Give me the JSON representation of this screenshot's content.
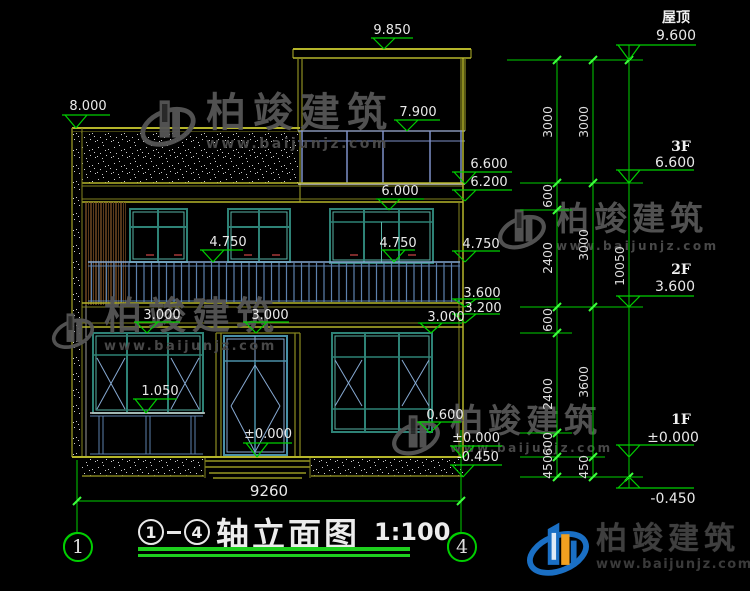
{
  "title_block": {
    "axis_from": "1",
    "axis_to": "4",
    "title": "轴立面图",
    "scale": "1:100"
  },
  "axis_bubbles": {
    "left": "1",
    "right": "4"
  },
  "bottom_dim": {
    "total_width": "9260"
  },
  "watermark": {
    "brand": "柏竣建筑",
    "url": "www.baijunjz.com"
  },
  "brand_footer": {
    "brand": "柏竣建筑",
    "url": "www.baijunjz.com"
  },
  "colors": {
    "dim_green": "#00cf00",
    "wall_olive": "#8f8f2d",
    "frame_teal": "#2e8276",
    "rail_blue": "#5d81ad",
    "logo_blue": "#1a6fc4",
    "logo_orange": "#f0a020"
  },
  "drawing": {
    "marks": [
      {
        "t": "9.850",
        "x": 392,
        "y": 24,
        "u": [
          371,
          413,
          38
        ],
        "tip": [
          384,
          49
        ]
      },
      {
        "t": "8.000",
        "x": 88,
        "y": 100,
        "u": [
          62,
          110,
          115
        ],
        "tip": [
          76,
          128
        ]
      },
      {
        "t": "7.900",
        "x": 418,
        "y": 106,
        "u": [
          394,
          440,
          120
        ],
        "tip": [
          407,
          131
        ]
      },
      {
        "t": "6.600",
        "x": 489,
        "y": 158,
        "u": [
          452,
          512,
          172
        ],
        "tip": [
          465,
          184
        ]
      },
      {
        "t": "6.200",
        "x": 489,
        "y": 176,
        "u": [
          452,
          512,
          190
        ],
        "tip": [
          465,
          201
        ]
      },
      {
        "t": "6.000",
        "x": 400,
        "y": 185,
        "u": [
          376,
          424,
          199
        ],
        "tip": [
          389,
          210
        ]
      },
      {
        "t": "4.750",
        "x": 228,
        "y": 236,
        "u": [
          200,
          243,
          250
        ],
        "tip": [
          213,
          262
        ]
      },
      {
        "t": "4.750",
        "x": 398,
        "y": 237,
        "u": [
          381,
          415,
          250
        ],
        "tip": [
          394,
          262
        ]
      },
      {
        "t": "4.750",
        "x": 481,
        "y": 238,
        "u": [
          452,
          500,
          251
        ],
        "tip": [
          465,
          262
        ]
      },
      {
        "t": "3.600",
        "x": 482,
        "y": 287,
        "u": [
          452,
          500,
          299
        ],
        "tip": [
          465,
          307
        ]
      },
      {
        "t": "3.200",
        "x": 483,
        "y": 302,
        "u": [
          452,
          500,
          314
        ],
        "tip": [
          465,
          323
        ]
      },
      {
        "t": "3.000",
        "x": 162,
        "y": 309,
        "u": [
          134,
          180,
          322
        ],
        "tip": [
          147,
          333
        ]
      },
      {
        "t": "3.000",
        "x": 270,
        "y": 309,
        "u": [
          243,
          289,
          322
        ],
        "tip": [
          256,
          333
        ]
      },
      {
        "t": "3.000",
        "x": 446,
        "y": 311,
        "u": [
          418,
          462,
          323
        ],
        "tip": [
          431,
          333
        ]
      },
      {
        "t": "1.050",
        "x": 160,
        "y": 385,
        "u": [
          133,
          177,
          399
        ],
        "tip": [
          146,
          413
        ]
      },
      {
        "t": "±0.000",
        "x": 268,
        "y": 428,
        "u": [
          243,
          292,
          443
        ],
        "tip": [
          257,
          457
        ]
      },
      {
        "t": "0.600",
        "x": 445,
        "y": 409,
        "u": [
          417,
          461,
          422
        ],
        "tip": [
          430,
          433
        ]
      },
      {
        "t": "±0.000",
        "x": 476,
        "y": 432,
        "u": [
          450,
          502,
          446
        ],
        "tip": [
          463,
          458
        ]
      },
      {
        "t": "-0.450",
        "x": 478,
        "y": 451,
        "u": [
          450,
          502,
          465
        ],
        "tip": [
          463,
          477
        ]
      }
    ],
    "floor_marks": [
      {
        "name": "屋顶",
        "value": "9.600",
        "nx": 676,
        "ny": 11,
        "vx": 676,
        "vy": 29,
        "u": [
          616,
          696,
          45
        ],
        "tip": [
          629,
          60
        ]
      },
      {
        "name": "3F",
        "value": "6.600",
        "nx": 681,
        "ny": 140,
        "vx": 675,
        "vy": 156,
        "u": [
          616,
          694,
          170
        ],
        "tip": [
          629,
          183
        ]
      },
      {
        "name": "2F",
        "value": "3.600",
        "nx": 681,
        "ny": 263,
        "vx": 675,
        "vy": 280,
        "u": [
          616,
          694,
          296
        ],
        "tip": [
          629,
          307
        ]
      },
      {
        "name": "1F",
        "value": "±0.000",
        "nx": 681,
        "ny": 413,
        "vx": 673,
        "vy": 431,
        "u": [
          616,
          694,
          445
        ],
        "tip": [
          629,
          457
        ]
      },
      {
        "name": "",
        "value": "-0.450",
        "nx": 0,
        "ny": 0,
        "vx": 673,
        "vy": 492,
        "u": [
          616,
          694,
          488
        ],
        "tip": [
          629,
          477
        ]
      }
    ],
    "chain_labels": [
      {
        "t": "3000",
        "x": 548,
        "y": 122
      },
      {
        "t": "600",
        "x": 548,
        "y": 196
      },
      {
        "t": "2400",
        "x": 548,
        "y": 258
      },
      {
        "t": "600",
        "x": 548,
        "y": 320
      },
      {
        "t": "2400",
        "x": 548,
        "y": 394
      },
      {
        "t": "600",
        "x": 548,
        "y": 444
      },
      {
        "t": "450",
        "x": 548,
        "y": 467
      },
      {
        "t": "3000",
        "x": 584,
        "y": 122
      },
      {
        "t": "3000",
        "x": 584,
        "y": 245
      },
      {
        "t": "3600",
        "x": 584,
        "y": 382
      },
      {
        "t": "450",
        "x": 584,
        "y": 467
      },
      {
        "t": "10050",
        "x": 620,
        "y": 266
      }
    ]
  }
}
